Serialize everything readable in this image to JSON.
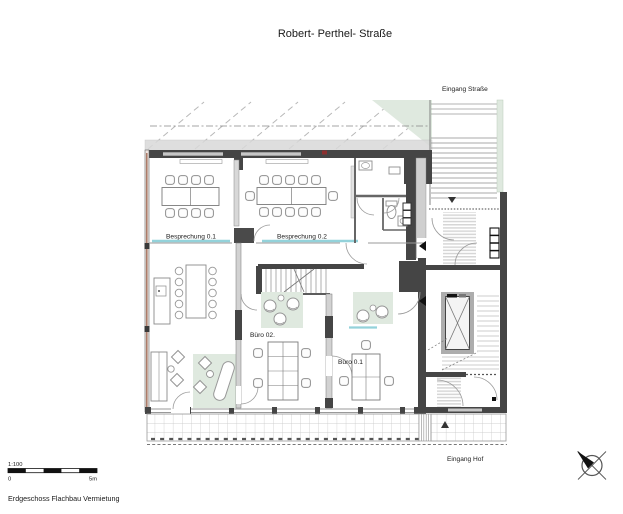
{
  "title": "Robert- Perthel- Straße",
  "annotations": {
    "entrance_street": "Eingang Straße",
    "entrance_court": "Eingang Hof"
  },
  "rooms": {
    "meeting1": "Besprechung 0.1",
    "meeting2": "Besprechung 0.2",
    "office2": "Büro 02.",
    "office1": "Büro 0.1"
  },
  "scale_bar": {
    "ratio": "1:100",
    "zero": "0",
    "max": "5m"
  },
  "caption": "Erdgeschoss Flachbau Vermietung",
  "colors": {
    "wall_dark": "#454545",
    "glass_cyan": "#93d2da",
    "green_fill": "#dfe9df",
    "masonry_red": "#a4705c"
  }
}
